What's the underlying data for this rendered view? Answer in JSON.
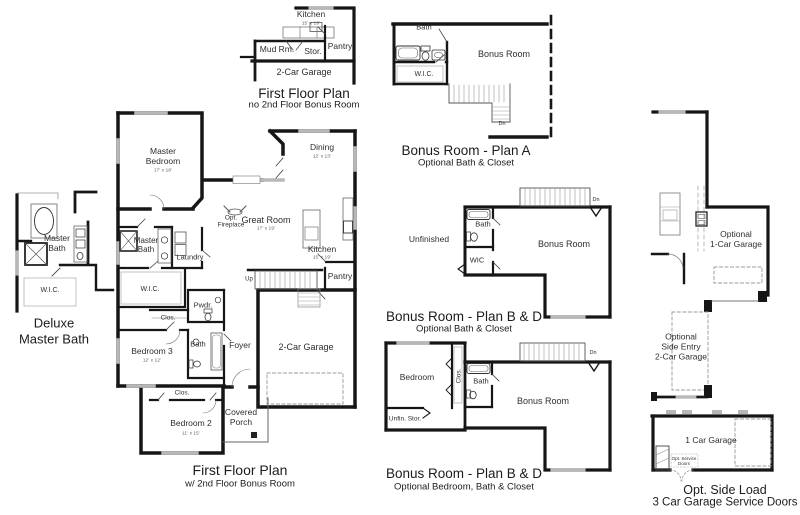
{
  "palette": {
    "background": "#ffffff",
    "walls": "#161616",
    "windows": "#b8b8b8",
    "thin_lines": "#777777",
    "dashed_optional": "#9a9a9a",
    "text": "#2e2e2e"
  },
  "plans": {
    "no_bonus": {
      "title": "First Floor Plan",
      "subtitle": "no 2nd Floor Bonus Room",
      "labels": {
        "kitchen": "Kitchen",
        "kitchen_dim": "15' x 19'",
        "mud_rm": "Mud Rm.",
        "stor": "Stor.",
        "pantry": "Pantry",
        "garage": "2-Car Garage"
      }
    },
    "bonus_a": {
      "title": "Bonus Room - Plan A",
      "subtitle": "Optional Bath & Closet",
      "labels": {
        "bath": "Bath",
        "bonus_room": "Bonus Room",
        "wic": "W.I.C.",
        "dn": "Dn"
      }
    },
    "deluxe": {
      "title": [
        "Deluxe",
        "Master Bath"
      ],
      "labels": {
        "master_bath": [
          "Master",
          "Bath"
        ],
        "wic": "W.I.C."
      }
    },
    "main": {
      "title": "First Floor Plan",
      "subtitle": "w/ 2nd Floor Bonus Room",
      "labels": {
        "master_bedroom": [
          "Master",
          "Bedroom"
        ],
        "master_bedroom_dim": "17' x 18'",
        "dining": "Dining",
        "dining_dim": "12' x 13'",
        "great_room": "Great Room",
        "great_room_dim": "17' x 19'",
        "opt_fireplace": [
          "Opt.",
          "Fireplace"
        ],
        "master_bath": [
          "Master",
          "Bath"
        ],
        "laundry": "Laundry",
        "wic": "W.I.C.",
        "pwdr": "Pwdr.",
        "clos_hall": "Clos.",
        "bedroom3": "Bedroom 3",
        "bedroom3_dim": "12' x 12'",
        "bath": "Bath",
        "foyer": "Foyer",
        "kitchen": "Kitchen",
        "kitchen_dim": "15' x 19'",
        "pantry": "Pantry",
        "up": "Up",
        "garage": "2-Car Garage",
        "clos_bedroom2": "Clos.",
        "bedroom2": "Bedroom 2",
        "bedroom2_dim": "11' x 15'",
        "covered_porch": [
          "Covered",
          "Porch"
        ]
      }
    },
    "bd_bath": {
      "title": "Bonus Room - Plan B & D",
      "subtitle": "Optional Bath & Closet",
      "labels": {
        "unfinished": "Unfinished",
        "bath": "Bath",
        "wic": "WIC",
        "bonus_room": "Bonus Room",
        "dn": "Dn"
      }
    },
    "bd_bedroom": {
      "title": "Bonus Room - Plan B & D",
      "subtitle": "Optional Bedroom, Bath & Closet",
      "labels": {
        "bedroom": "Bedroom",
        "clos": "Clos.",
        "bath": "Bath",
        "bonus_room": "Bonus Room",
        "unfin_stor": "Unfin. Stor.",
        "dn": "Dn"
      }
    },
    "garages": {
      "one_car_optional": [
        "Optional",
        "1-Car Garage"
      ],
      "side_entry": [
        "Optional",
        "Side Entry",
        "2-Car Garage"
      ],
      "one_car_garage": "1 Car Garage",
      "service_doors": [
        "Opt. Service",
        "Doors"
      ],
      "side_load_title": "Opt. Side Load",
      "side_load_subtitle": "3 Car Garage Service Doors"
    }
  }
}
